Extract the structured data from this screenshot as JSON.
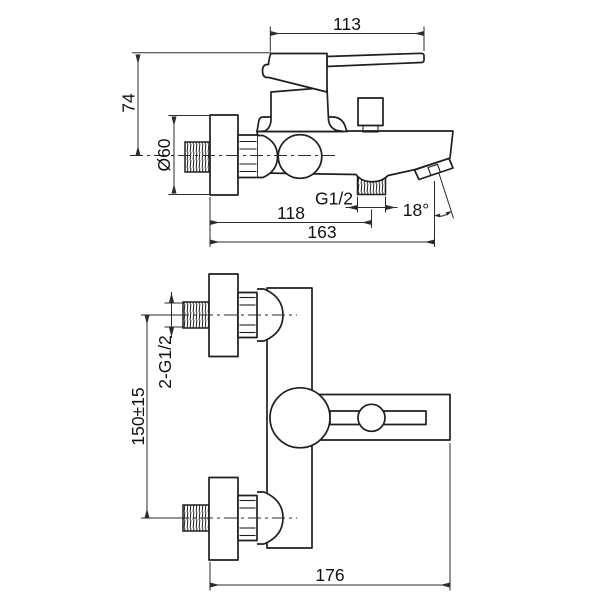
{
  "page": {
    "background": "#ffffff"
  },
  "diagram": {
    "type": "technical-dimension-drawing",
    "subject": "wall-mounted bath shower mixer tap, two orthographic views",
    "line_color": "#1f1f1f",
    "views": [
      {
        "id": "side-view",
        "dimensions": {
          "handle_length": "113",
          "height_top": "74",
          "flange_diameter": "Ø60",
          "outlet_thread": "G1/2",
          "outlet_offset": "118",
          "total_depth": "163",
          "spout_angle": "18°"
        }
      },
      {
        "id": "front-view",
        "dimensions": {
          "inlet_thread": "2-G1/2",
          "inlet_spacing": "150±15",
          "total_width": "176"
        }
      }
    ]
  }
}
